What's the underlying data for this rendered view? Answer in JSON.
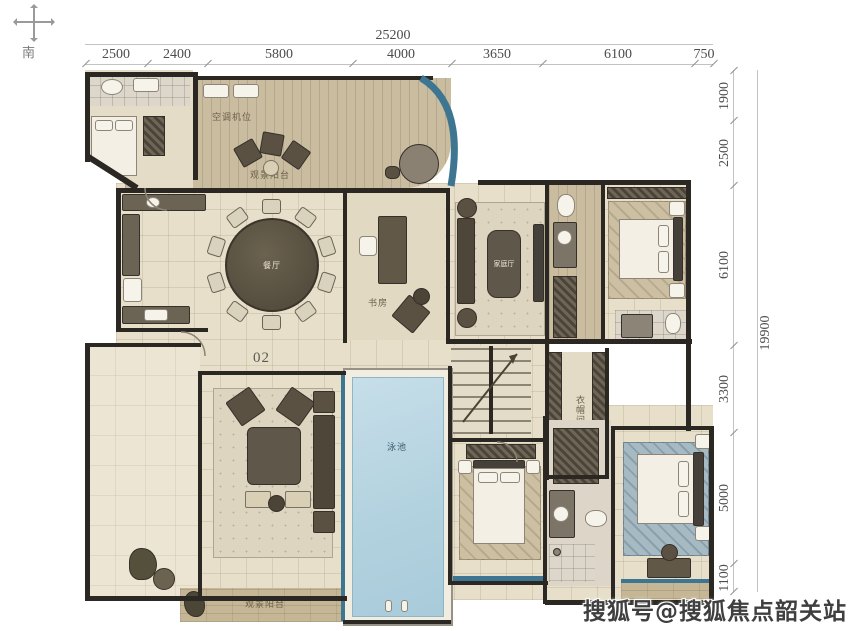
{
  "compass": {
    "south": "南"
  },
  "dims": {
    "top_total": "25200",
    "top_segments": [
      "2500",
      "2400",
      "5800",
      "4000",
      "3650",
      "6100",
      "750"
    ],
    "right_total": "19900",
    "right_segments": [
      "1900",
      "2500",
      "6100",
      "3300",
      "5000",
      "1100"
    ]
  },
  "plan": {
    "unit_number": "02",
    "labels": {
      "ac_unit": "空调机位",
      "service_balcony": "生活阳台",
      "leisure_balcony_top": "观景阳台",
      "dining": "餐厅",
      "study": "书房",
      "family_room": "家庭厅",
      "closet": "衣帽间",
      "pool": "泳池",
      "leisure_balcony_bottom": "观景阳台"
    },
    "colors": {
      "wall": "#2b2722",
      "glass": "#3e7691",
      "pool_water": "#b3d2df",
      "floor": "#e7dfca"
    }
  },
  "watermark": "搜狐号@搜狐焦点韶关站"
}
